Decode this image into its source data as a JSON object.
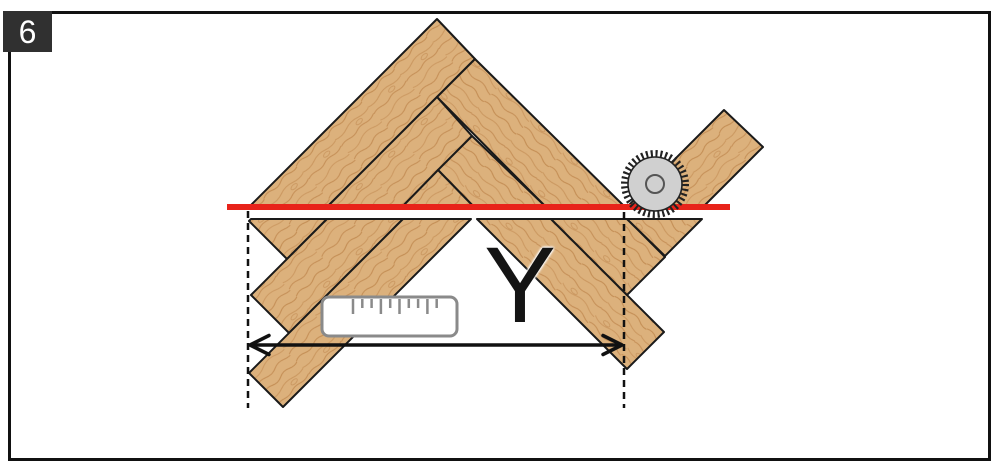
{
  "figure": {
    "number": "6"
  },
  "labels": {
    "dimension": "Y"
  },
  "colors": {
    "background": "#ffffff",
    "wood": "#dcb17c",
    "wood_grain": "#bb8147",
    "outline": "#1a1a1a",
    "cut_line": "#e8231a",
    "blade_body": "#d0d0d0",
    "blade_edge": "#222222",
    "ruler": "#8a8a8a",
    "marks": "#111111",
    "frame": "#111111",
    "badge_bg": "#303030",
    "badge_text": "#ffffff"
  },
  "icons": [
    {
      "name": "saw-blade-icon",
      "meaning": "circular saw blade cutting along red line"
    },
    {
      "name": "ruler-icon",
      "meaning": "measuring ruler"
    }
  ],
  "diagram": {
    "cut_line": {
      "x": 227,
      "y": 204,
      "width": 503,
      "height": 6
    },
    "kerf_gap": {
      "top_section_bottom": 208,
      "bottom_section_top": 219
    },
    "dashed_lines": [
      {
        "x": 248,
        "y1": 211,
        "y2": 408
      },
      {
        "x": 624,
        "y1": 212,
        "y2": 408
      }
    ],
    "arrow": {
      "x1": 250,
      "x2": 622,
      "y": 345
    },
    "saw_blade": {
      "cx": 655,
      "cy": 184,
      "body_r": 27,
      "teeth_r": 30.5,
      "hub_r": 9
    },
    "ruler": {
      "x": 322,
      "y": 297,
      "width": 135,
      "height": 39,
      "ticks_start": 353,
      "tick_step": 9.3,
      "tick_heights": [
        15,
        9,
        9,
        15,
        9,
        15,
        9,
        9,
        15,
        9
      ]
    },
    "planks": [
      {
        "name": "top-left-long",
        "orientation": "ne",
        "points": "248,208 437,19 475,59 326,208"
      },
      {
        "name": "top-right-long",
        "orientation": "nw",
        "points": "475,59 626,208 547,208 437,97"
      },
      {
        "name": "top-inner-left",
        "orientation": "ne",
        "points": "437,97 472,136 401,208 326,208"
      },
      {
        "name": "top-inner-right",
        "orientation": "nw",
        "points": "472,136 547,208 475,208 438,170"
      },
      {
        "name": "top-center-small",
        "orientation": "ne",
        "points": "438,170 475,208 401,208"
      },
      {
        "name": "offcut-plank",
        "orientation": "ne",
        "points": "627,207 724,110 763,147 702,208"
      },
      {
        "name": "bottom-left-short",
        "orientation": "ne",
        "points": "251,219 327,219 287,259 249,221"
      },
      {
        "name": "bottom-left-mid",
        "orientation": "ne",
        "points": "327,219 403,219 289,333 251,295"
      },
      {
        "name": "bottom-left-long",
        "orientation": "ne",
        "points": "403,219 471,219 283,407 249,373"
      },
      {
        "name": "bottom-center-long",
        "orientation": "nw",
        "points": "477,219 551,219 664,332 627,369"
      },
      {
        "name": "bottom-right-mid",
        "orientation": "nw",
        "points": "551,219 627,219 665,257 627,295"
      },
      {
        "name": "bottom-right-short",
        "orientation": "nw",
        "points": "627,219 702,219 665,256"
      }
    ]
  }
}
